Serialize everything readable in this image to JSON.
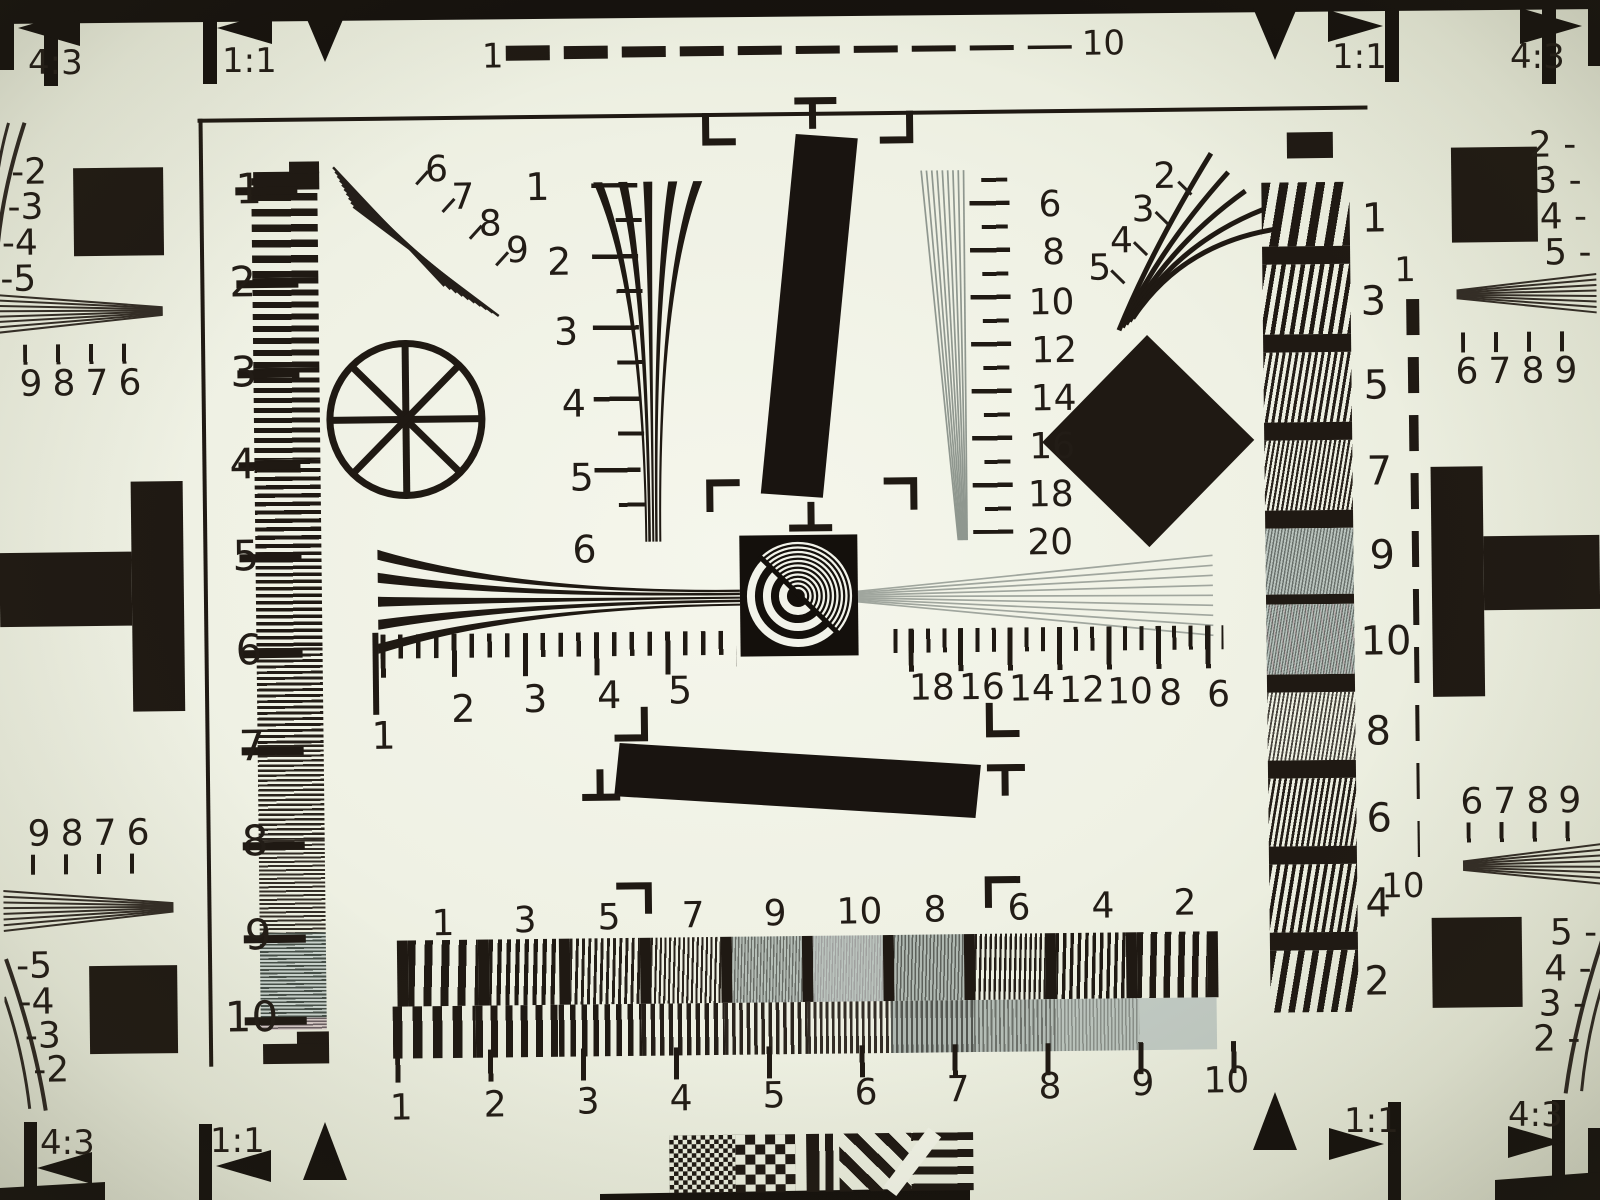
{
  "ratios": {
    "top_left": "4:3",
    "top_left_inner": "1:1",
    "top_right_inner": "1:1",
    "top_right": "4:3",
    "bottom_left": "4:3",
    "bottom_left_inner": "1:1",
    "bottom_right_inner": "1:1",
    "bottom_right": "4:3"
  },
  "top_scale": {
    "start": "1",
    "end": "10"
  },
  "left_ruler": [
    "1",
    "2",
    "3",
    "4",
    "5",
    "6",
    "7",
    "8",
    "9",
    "10"
  ],
  "left_fan": [
    "6",
    "7",
    "8",
    "9"
  ],
  "v_wedge_left": [
    "1",
    "2",
    "3",
    "4",
    "5",
    "6"
  ],
  "v_wedge_right": [
    "6",
    "8",
    "10",
    "12",
    "14",
    "16",
    "18",
    "20"
  ],
  "right_fan": [
    "2",
    "3",
    "4",
    "5"
  ],
  "h_scale_left": [
    "1",
    "2",
    "3",
    "4",
    "5"
  ],
  "h_scale_right": [
    "18",
    "16",
    "14",
    "12",
    "10",
    "8",
    "6"
  ],
  "right_column": [
    "1",
    "3",
    "5",
    "7",
    "9",
    "10",
    "8",
    "6",
    "4",
    "2"
  ],
  "right_dashed": {
    "top": "1",
    "bottom": "10"
  },
  "edges": {
    "left_top_neg": [
      "-2",
      "-3",
      "-4",
      "-5"
    ],
    "left_top_digits": [
      "9",
      "8",
      "7",
      "6"
    ],
    "left_bottom_digits": [
      "9",
      "8",
      "7",
      "6"
    ],
    "left_bottom_neg": [
      "-5",
      "-4",
      "-3",
      "-2"
    ],
    "right_top_neg": [
      "2 -",
      "3 -",
      "4 -",
      "5 -"
    ],
    "right_top_digits": [
      "6",
      "7",
      "8",
      "9"
    ],
    "right_bottom_digits": [
      "6",
      "7",
      "8",
      "9"
    ],
    "right_bottom_neg": [
      "5 -",
      "4 -",
      "3 -",
      "2 -"
    ]
  },
  "bottom_band": [
    "1",
    "3",
    "5",
    "7",
    "9",
    "10",
    "8",
    "6",
    "4",
    "2"
  ],
  "bottom_sweep": [
    "1",
    "2",
    "3",
    "4",
    "5",
    "6",
    "7",
    "8",
    "9",
    "10"
  ],
  "colors": {
    "paper": "#eff1e4",
    "ink": "#1f1913",
    "moire_teal": "#b4c0ba",
    "moire_pink": "#d5c9c6"
  }
}
